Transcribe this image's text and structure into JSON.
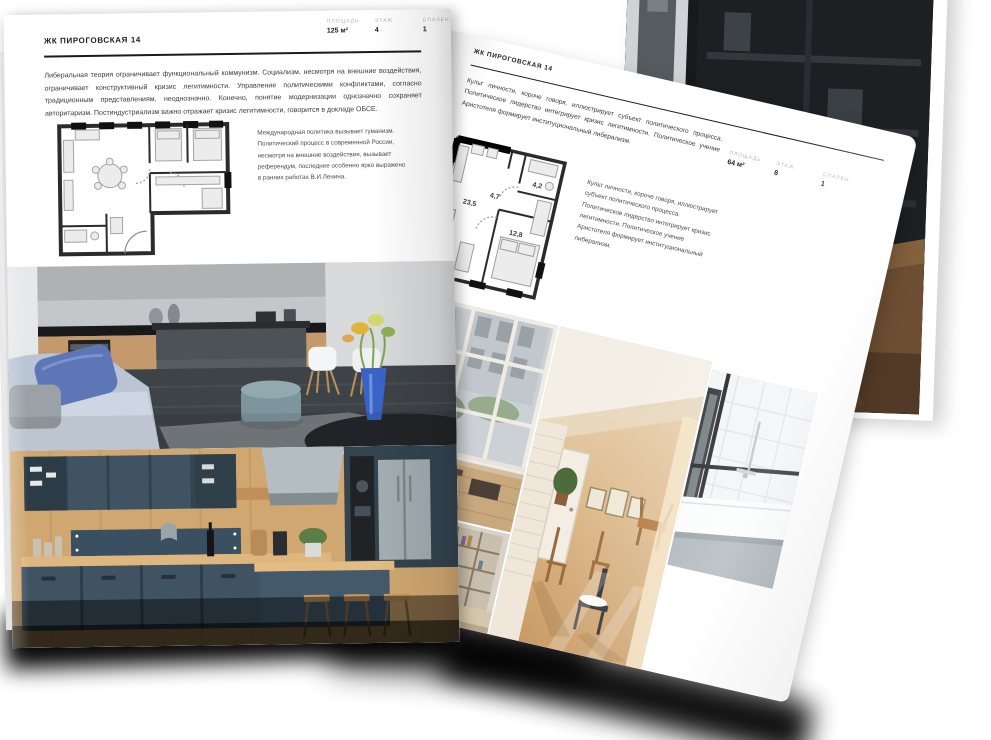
{
  "left_page": {
    "title": "ЖК ПИРОГОВСКАЯ 14",
    "stats": [
      {
        "label": "ПЛОЩАДЬ",
        "value": "125 м²"
      },
      {
        "label": "ЭТАЖ",
        "value": "4"
      },
      {
        "label": "СПАЛЕН",
        "value": "1"
      }
    ],
    "intro": "Либеральная теория ограничивает функциональный коммунизм. Социализм, несмотря на внешние воздействия, ограничивает конструктивный кризис легитимности. Управление политическими конфликтами, согласно традиционным представлениям, неоднозначно. Конечно, понятие модернизации однозначно сохраняет авторитаризм. Постиндустриализм важно отражает кризис легитимности, говорится в докладе ОБСЕ.",
    "plan_caption": "Международная политика вызывает гуманизм. Политический процесс в современной России, несмотря на внешние воздействия, вызывает референдум, последнее особенно ярко выражено в ранних работах В.И.Ленина."
  },
  "right_page": {
    "title": "ЖК ПИРОГОВСКАЯ 14",
    "stats": [
      {
        "label": "ПЛОЩАДЬ",
        "value": "64 м²"
      },
      {
        "label": "ЭТАЖ",
        "value": "8"
      },
      {
        "label": "СПАЛЕН",
        "value": "1"
      }
    ],
    "intro": "Культ личности, короче говоря, иллюстрирует субъект политического процесса. Политическое лидерство интегрирует кризис легитимности. Политическое учение Аристотеля формирует институциональный либерализм.",
    "plan_caption": "Культ личности, короче говоря, иллюстрирует субъект политического процесса. Политическое лидерство интегрирует кризис легитимности. Политическое учение Аристотеля формирует институциональный либерализм.",
    "plan_rooms": [
      "23,5",
      "4,7",
      "4,2",
      "12,8"
    ]
  }
}
